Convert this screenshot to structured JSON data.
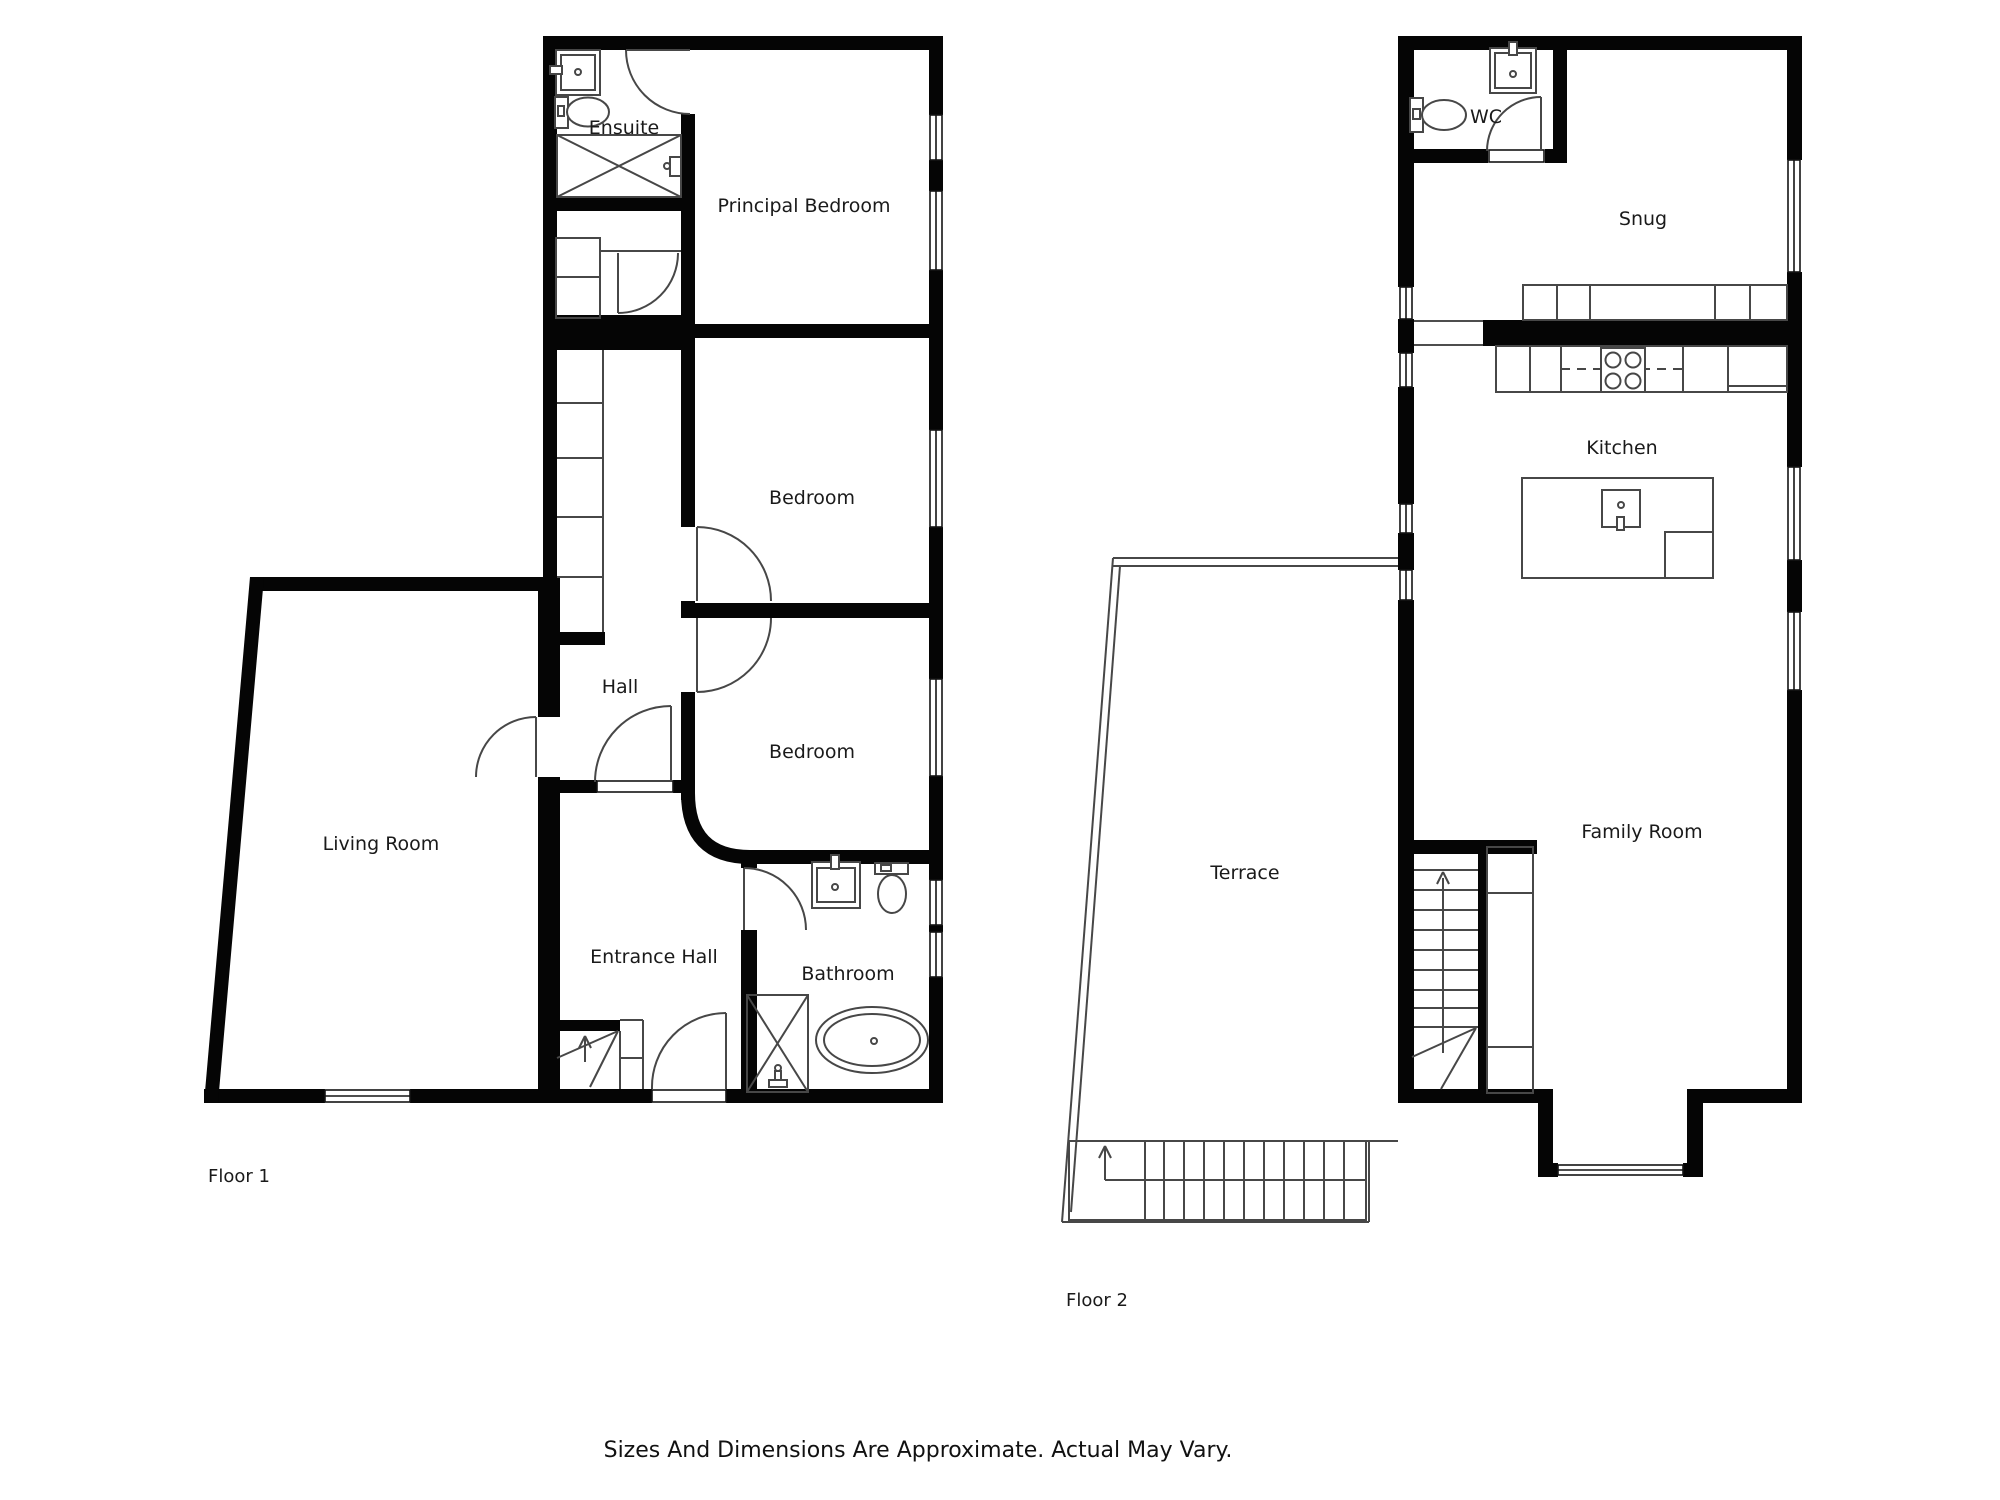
{
  "caption": "Sizes And Dimensions Are Approximate. Actual May Vary.",
  "colors": {
    "wall": "#050505",
    "fixture_line": "#474747",
    "text": "#1a1a1a"
  },
  "floor1": {
    "name": "Floor 1",
    "rooms": {
      "ensuite": "Ensuite",
      "principal_bedroom": "Principal Bedroom",
      "bedroom1": "Bedroom",
      "hall": "Hall",
      "bedroom2": "Bedroom",
      "living_room": "Living Room",
      "entrance_hall": "Entrance Hall",
      "bathroom": "Bathroom"
    },
    "fixtures": [
      "sink-icon",
      "toilet-icon",
      "shower-icon",
      "wardrobe-icon",
      "stairs-icon",
      "bath-icon",
      "door-arc-icon",
      "window-icon"
    ]
  },
  "floor2": {
    "name": "Floor 2",
    "rooms": {
      "wc": "WC",
      "snug": "Snug",
      "kitchen": "Kitchen",
      "terrace": "Terrace",
      "family_room": "Family Room"
    },
    "fixtures": [
      "sink-icon",
      "toilet-icon",
      "hob-icon",
      "kitchen-island-icon",
      "counter-icon",
      "stairs-icon",
      "terrace-steps-icon",
      "window-icon"
    ]
  }
}
